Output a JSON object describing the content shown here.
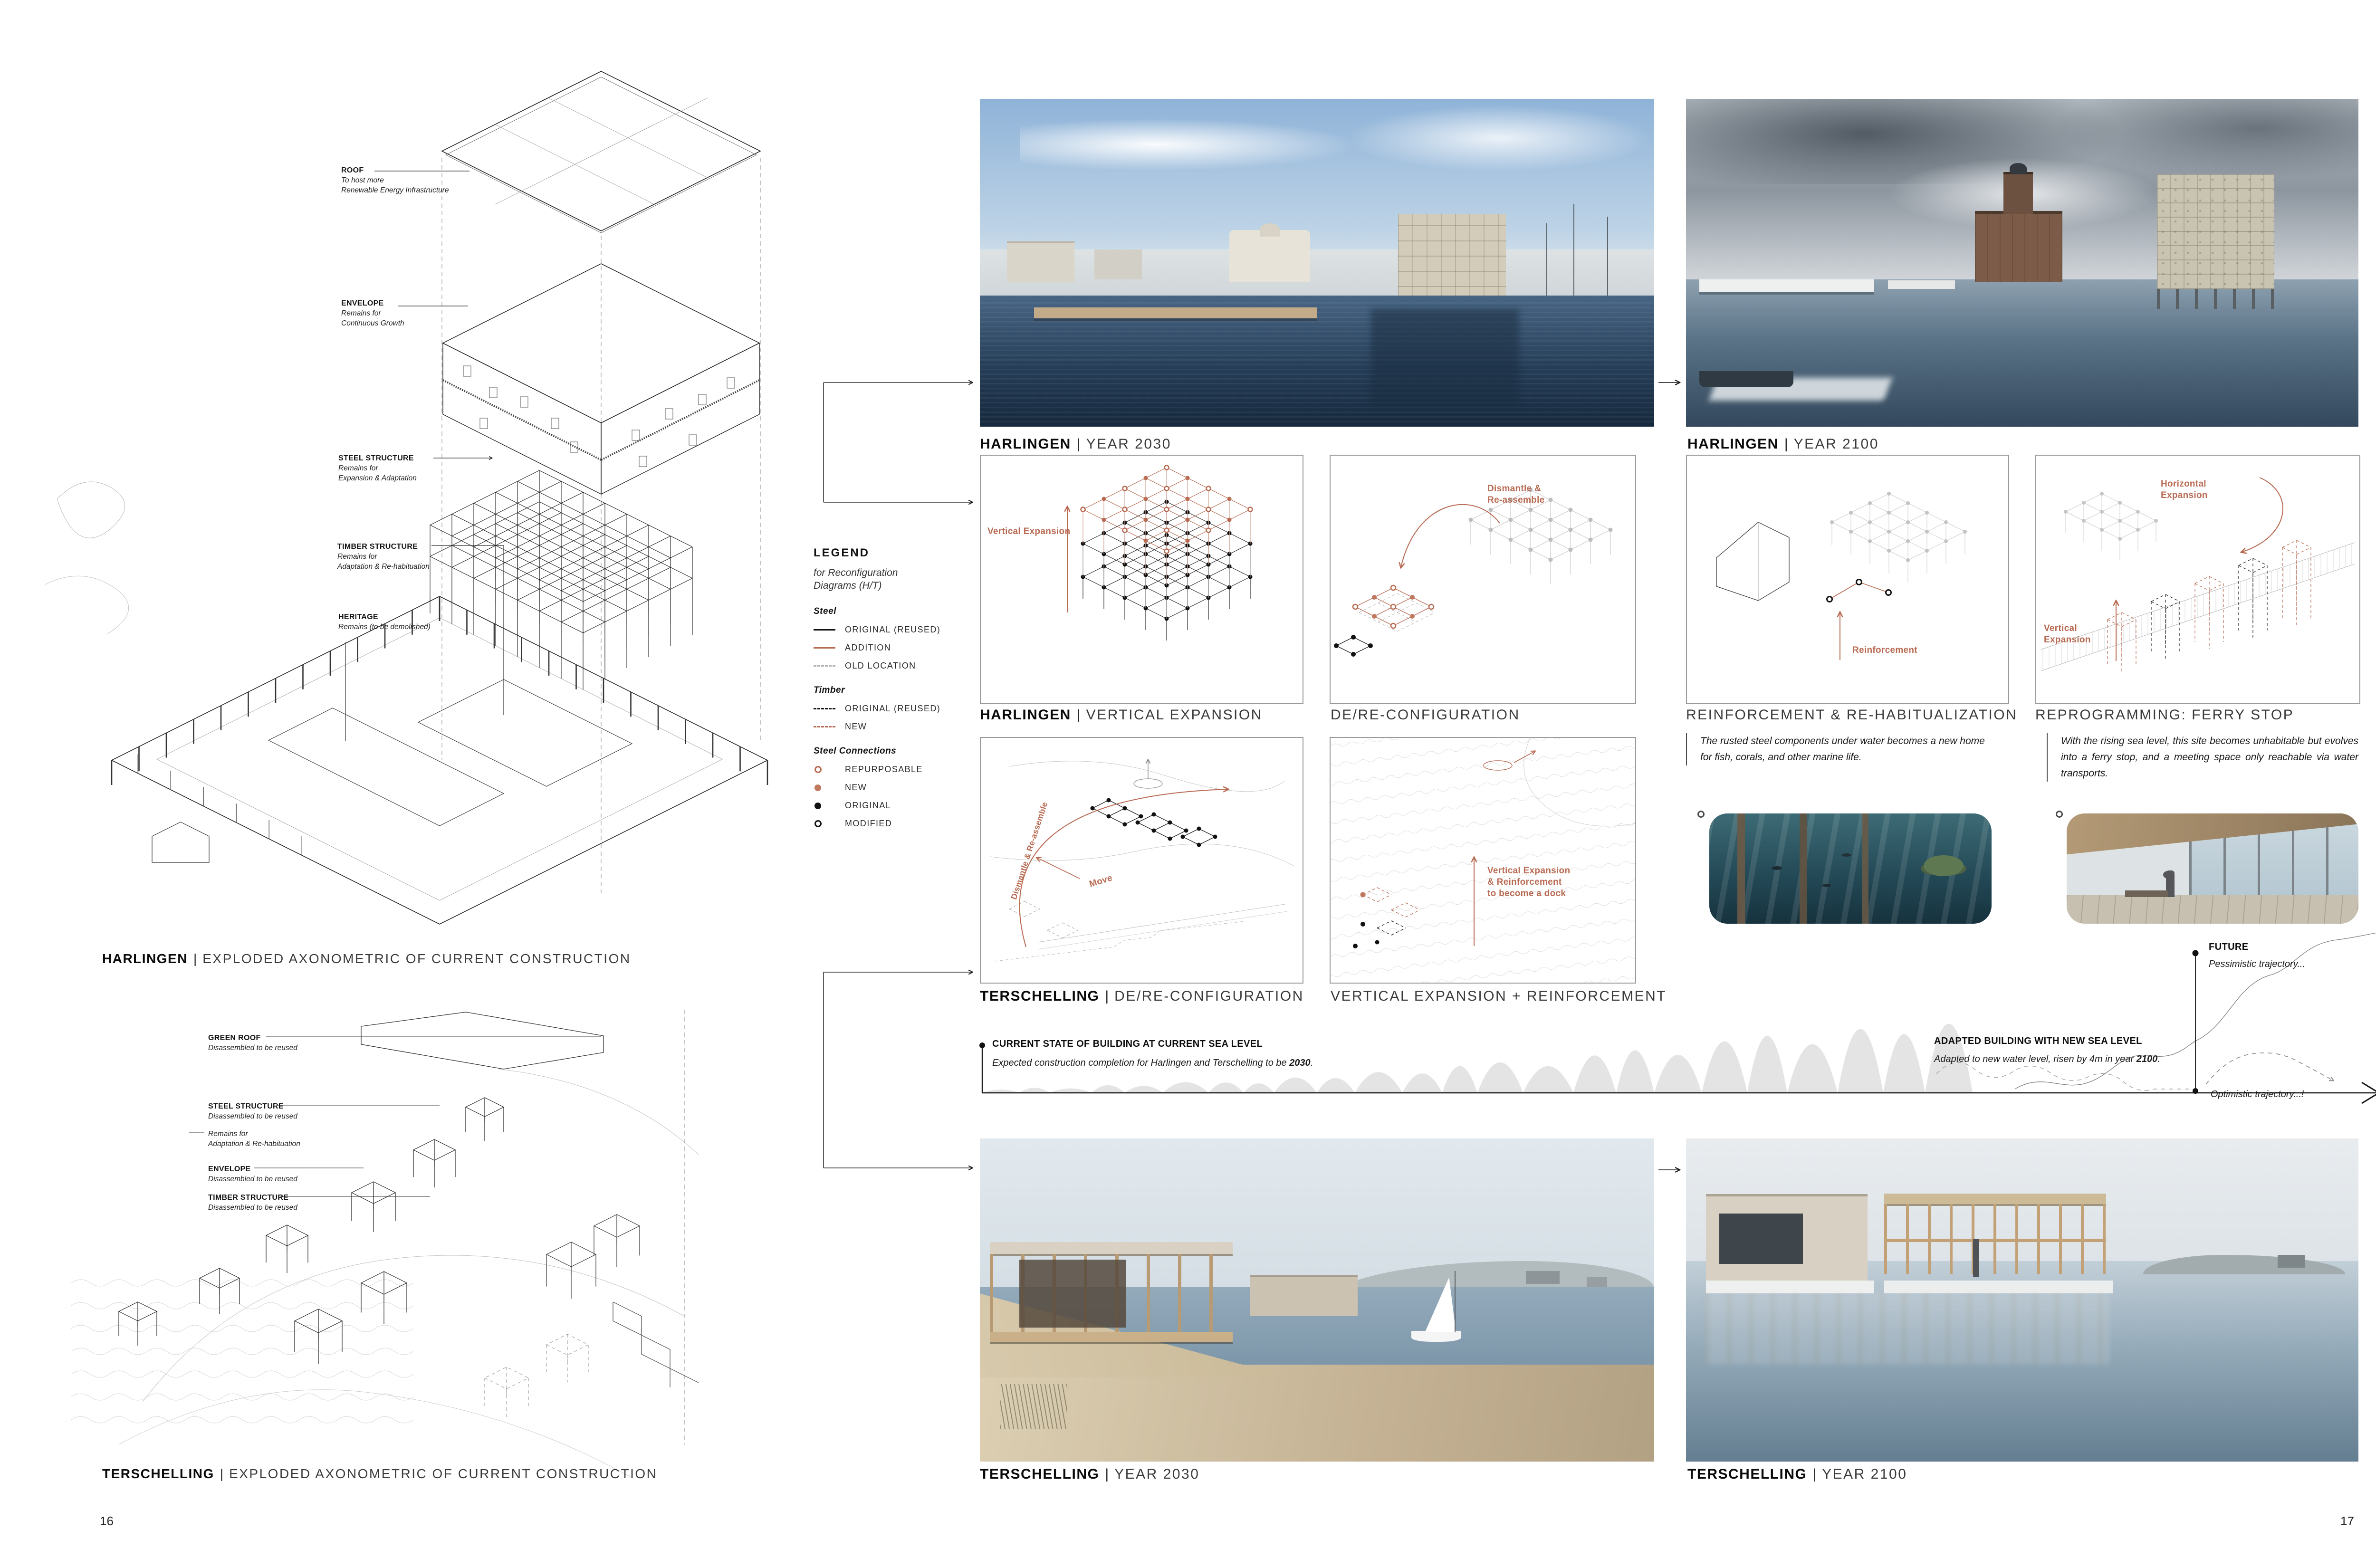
{
  "accent": "#b86a52",
  "pages": {
    "left": "16",
    "right": "17"
  },
  "axH": {
    "labels": [
      {
        "t": "ROOF",
        "d": "To host more\nRenewable Energy Infrastructure"
      },
      {
        "t": "ENVELOPE",
        "d": "Remains for\nContinuous Growth"
      },
      {
        "t": "STEEL STRUCTURE",
        "d": "Remains for\nExpansion & Adaptation"
      },
      {
        "t": "TIMBER STRUCTURE",
        "d": "Remains for\nAdaptation & Re-habituation"
      },
      {
        "t": "HERITAGE",
        "d": "Remains (to be demolished)"
      }
    ],
    "cap_b": "HARLINGEN",
    "sep": "|",
    "cap_r": "EXPLODED AXONOMETRIC OF CURRENT CONSTRUCTION"
  },
  "axT": {
    "labels": [
      {
        "t": "GREEN ROOF",
        "d": "Disassembled to be reused"
      },
      {
        "t": "STEEL STRUCTURE",
        "d": "Disassembled to be reused"
      },
      {
        "t": "ENVELOPE",
        "d": "Disassembled to be reused"
      },
      {
        "t": "TIMBER STRUCTURE",
        "d": "Disassembled to be reused"
      }
    ],
    "extra": "Remains for\nAdaptation & Re-habituation",
    "cap_b": "TERSCHELLING",
    "sep": "|",
    "cap_r": "EXPLODED AXONOMETRIC OF CURRENT CONSTRUCTION"
  },
  "legend": {
    "title": "LEGEND",
    "subtitle": "for Reconfiguration Diagrams (H/T)",
    "steel": {
      "name": "Steel",
      "i1": "ORIGINAL (REUSED)",
      "i2": "ADDITION",
      "i3": "OLD LOCATION"
    },
    "timber": {
      "name": "Timber",
      "i1": "ORIGINAL (REUSED)",
      "i2": "NEW"
    },
    "conn": {
      "name": "Steel Connections",
      "i1": "REPURPOSABLE",
      "i2": "NEW",
      "i3": "ORIGINAL",
      "i4": "MODIFIED"
    }
  },
  "renders": {
    "h2030": {
      "b": "HARLINGEN",
      "sep": "|",
      "r": "YEAR 2030"
    },
    "h2100": {
      "b": "HARLINGEN",
      "sep": "|",
      "r": "YEAR 2100"
    },
    "t2030": {
      "b": "TERSCHELLING",
      "sep": "|",
      "r": "YEAR 2030"
    },
    "t2100": {
      "b": "TERSCHELLING",
      "sep": "|",
      "r": "YEAR 2100"
    }
  },
  "diagrams": {
    "d1": {
      "b": "HARLINGEN",
      "sep": "|",
      "r": "VERTICAL EXPANSION",
      "a1": "Vertical Expansion"
    },
    "d2": {
      "r": "DE/RE-CONFIGURATION",
      "a1": "Dismantle &\nRe-assemble"
    },
    "d3": {
      "r": "REINFORCEMENT & RE-HABITUALIZATION",
      "a1": "Reinforcement",
      "note": "The rusted steel components under water becomes a new home for fish, corals, and other marine life."
    },
    "d4": {
      "r": "REPROGRAMMING: FERRY STOP",
      "a1": "Horizontal\nExpansion",
      "a2": "Vertical\nExpansion",
      "note": "With the rising sea level, this site becomes unhabitable but evolves into a ferry stop, and a meeting space only reachable via water transports."
    },
    "d5": {
      "b": "TERSCHELLING",
      "sep": "|",
      "r": "DE/RE-CONFIGURATION",
      "a1": "Dismantle & Re-assemble",
      "a2": "Move"
    },
    "d6": {
      "r": "VERTICAL EXPANSION + REINFORCEMENT",
      "a1": "Vertical Expansion\n& Reinforcement\nto become a dock"
    }
  },
  "timeline": {
    "m1": {
      "t": "CURRENT STATE OF BUILDING AT CURRENT SEA LEVEL",
      "p": "Expected construction completion for Harlingen and Terschelling to be ",
      "b": "2030",
      "s": "."
    },
    "m2": {
      "t": "ADAPTED BUILDING WITH NEW SEA LEVEL",
      "p": "Adapted to new water level, risen by 4m in year ",
      "b": "2100",
      "s": "."
    },
    "future": {
      "t": "FUTURE",
      "d": "Pessimistic trajectory..."
    },
    "optimistic": "Optimistic trajectory...!"
  }
}
